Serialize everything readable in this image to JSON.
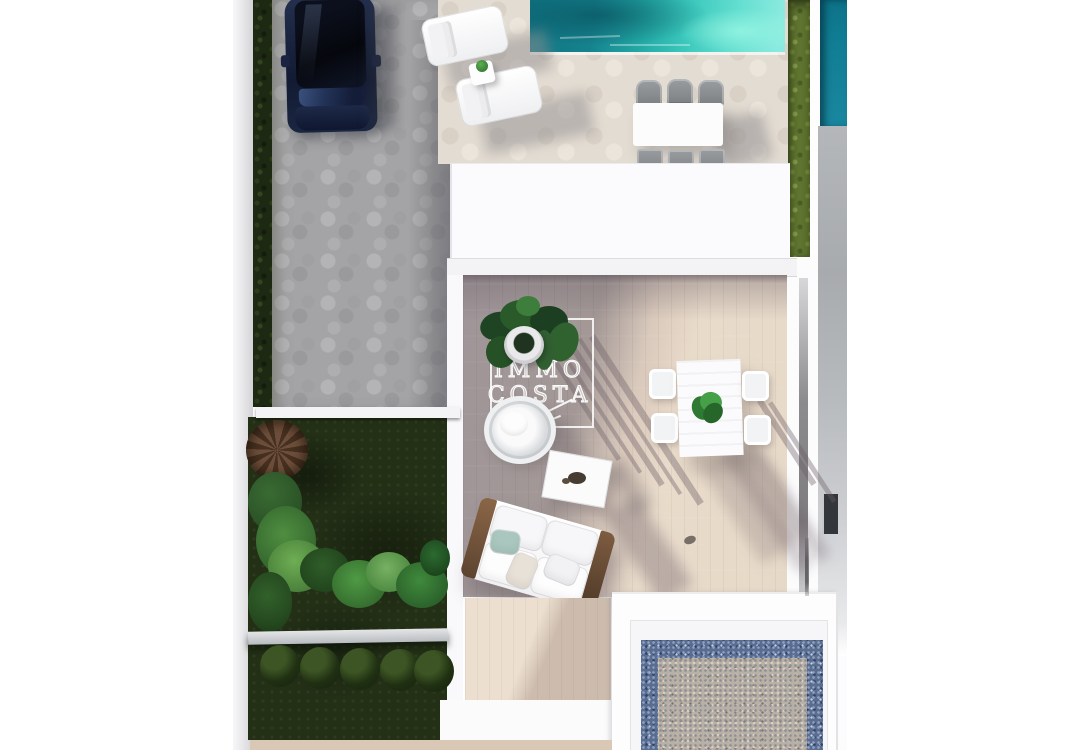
{
  "scene": {
    "type": "aerial-3d-architectural-render",
    "subject": "top-down view of a modern villa plot with swimming pool, sun deck, roofed courtyard terrace, garden and driveway with parked car",
    "watermark": {
      "line1": "IMMO",
      "line2": "COSTA"
    },
    "colors": {
      "pool_main": "#2cc4bb",
      "pool_deep": "#0f7280",
      "neighbour_pool": "#15829a",
      "terrace_cream": "#e6d8c8",
      "terrace_taupe": "#a0969a",
      "paving_gray": "#a4a4a6",
      "lawn_dark": "#233016",
      "hedge_olive": "#5f7430",
      "hedge_dark": "#1d2912",
      "car_navy": "#1a2440",
      "mosaic_blue": "#5a6d90",
      "mosaic_gray": "#b8afa5",
      "wood_brown": "#6b4c34",
      "wall_white": "#fdfdfe"
    },
    "objects": [
      {
        "name": "parked-car"
      },
      {
        "name": "swimming-pool"
      },
      {
        "name": "sun-lounger",
        "count": 2
      },
      {
        "name": "lounger-side-table"
      },
      {
        "name": "poolside-dining-set",
        "chairs": 6
      },
      {
        "name": "villa-roof"
      },
      {
        "name": "courtyard-terrace"
      },
      {
        "name": "outdoor-sofa"
      },
      {
        "name": "coffee-table"
      },
      {
        "name": "hanging-chair"
      },
      {
        "name": "potted-plant"
      },
      {
        "name": "terrace-dining-set",
        "chairs": 4
      },
      {
        "name": "garden-lawn"
      },
      {
        "name": "tropical-plants"
      },
      {
        "name": "hedge-balls",
        "count": 5
      },
      {
        "name": "privacy-hedge"
      },
      {
        "name": "neighbour-pool"
      },
      {
        "name": "mosaic-patio"
      }
    ]
  }
}
